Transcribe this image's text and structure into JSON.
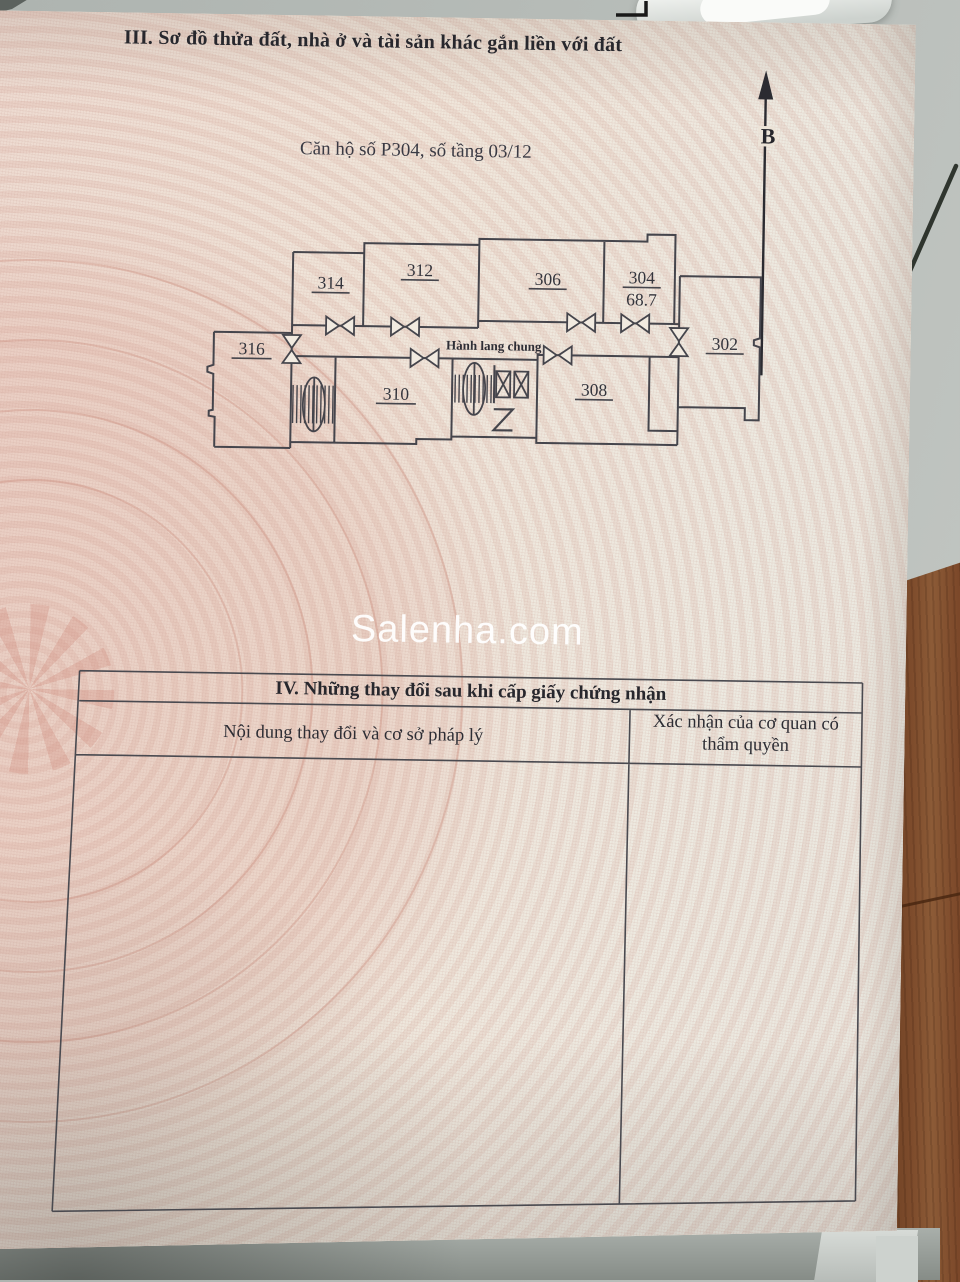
{
  "certificate": {
    "section3_title": "III. Sơ đồ thửa đất, nhà ở và tài sản khác gắn liền với đất",
    "apartment_info": "Căn hộ số P304, số tầng 03/12",
    "north_label": "B",
    "floor_plan": {
      "corridor_label": "Hành lang chung",
      "rooms": [
        {
          "number": "314"
        },
        {
          "number": "312"
        },
        {
          "number": "306"
        },
        {
          "number": "304",
          "area": "68.7"
        },
        {
          "number": "316"
        },
        {
          "number": "302"
        },
        {
          "number": "310"
        },
        {
          "number": "308"
        }
      ]
    },
    "section4_title": "IV. Những thay đổi sau khi cấp giấy chứng nhận",
    "section4_col1": "Nội dung thay đổi và cơ sở pháp lý",
    "section4_col2": "Xác nhận của cơ quan có thẩm quyền"
  },
  "watermark": "Salenha.com",
  "colors": {
    "paper": "#efe8dd",
    "guilloche_pink": "#dcb9ae",
    "ink": "#27272d",
    "plan_line": "#45454c",
    "background_grey": "#b6bbb7",
    "wood_brown": "#7b4729",
    "watermark_white": "#ffffff"
  }
}
